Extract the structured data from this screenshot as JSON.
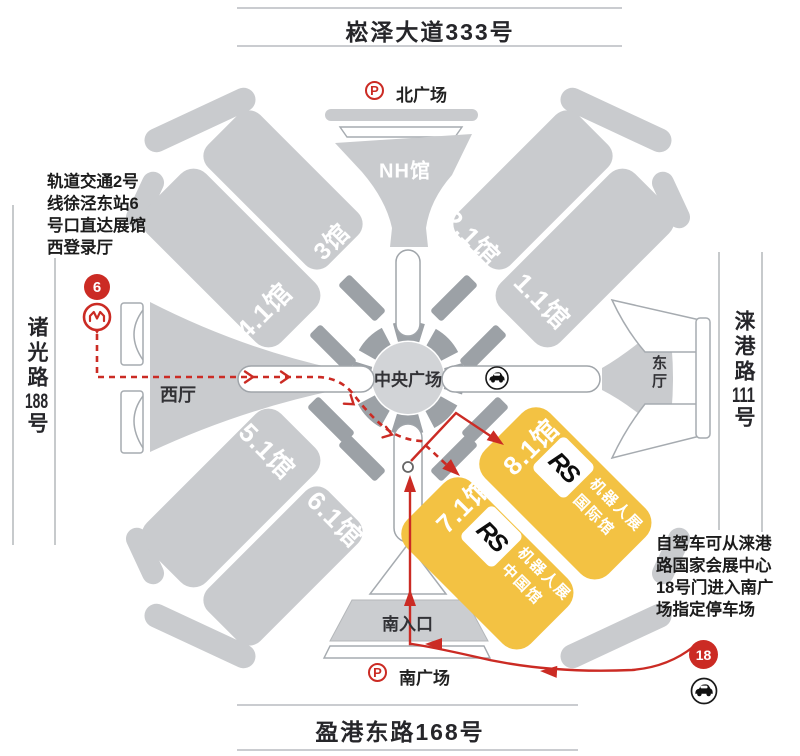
{
  "roads": {
    "top": "崧泽大道333号",
    "bottom": "盈港东路168号",
    "left": {
      "name": "诸光路",
      "number": "188",
      "suffix": "号"
    },
    "right": {
      "name": "涞港路",
      "number": "111",
      "suffix": "号"
    }
  },
  "plazas": {
    "north": "北广场",
    "south": "南广场",
    "central": "中央广场",
    "parking_symbol": "P"
  },
  "halls": {
    "nh": "NH馆",
    "h3": "3馆",
    "h41": "4.1馆",
    "h21": "2.1馆",
    "h11": "1.1馆",
    "h51": "5.1馆",
    "h61": "6.1馆",
    "h71": "7.1馆",
    "h81": "8.1馆"
  },
  "gates": {
    "west": "西厅",
    "east": "东厅",
    "south_entrance": "南入口"
  },
  "notes": {
    "metro": {
      "lines": [
        "轨道交通2号",
        "线徐泾东站6",
        "号口直达展馆",
        "西登录厅"
      ]
    },
    "drive": {
      "lines": [
        "自驾车可从涞港",
        "路国家会展中心",
        "18号门进入南广",
        "场指定停车场"
      ]
    }
  },
  "markers": {
    "metro_exit": "6",
    "drive_gate": "18"
  },
  "expo": {
    "logo": "RS",
    "name_line1": "机器人展",
    "international": "国际馆",
    "china": "中国馆"
  },
  "colors": {
    "accent_red": "#CB2B24",
    "hall_yellow": "#F3C243",
    "hall_gray": "#C9CBCE",
    "dark_gray": "#9CA1A6"
  }
}
